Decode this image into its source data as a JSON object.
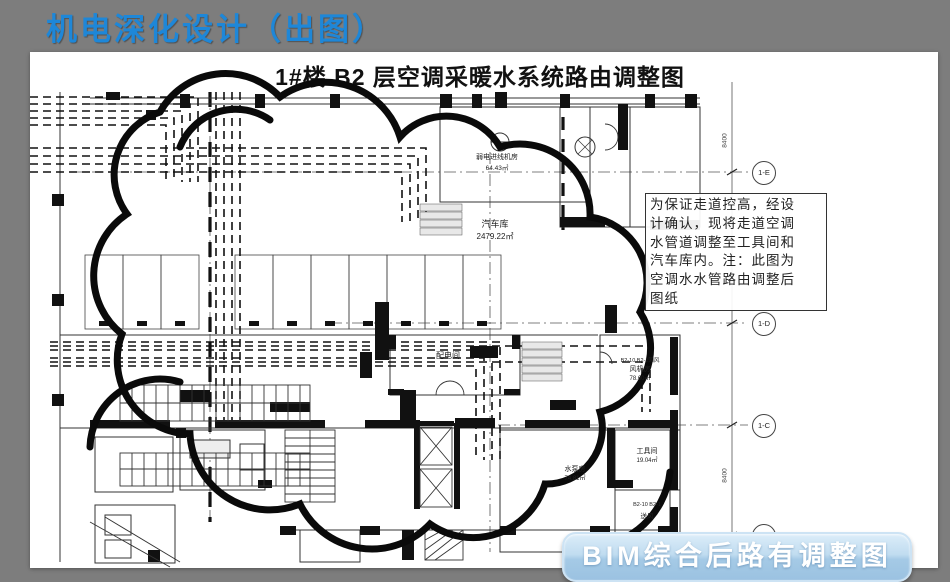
{
  "slide": {
    "title": "机电深化设计（出图）"
  },
  "drawing": {
    "title": "1#楼 B2 层空调采暖水系统路由调整图"
  },
  "annotation": {
    "text": "为保证走道控高，经设\n计确认，现将走道空调\n水管道调整至工具间和\n汽车库内。注：此图为\n空调水水管路由调整后\n图纸"
  },
  "caption_button": {
    "label": "BIM综合后路有调整图"
  },
  "plan": {
    "garage": {
      "name": "汽车库",
      "area": "2479.22㎡"
    },
    "rooms": [
      {
        "name": "弱电进线机房",
        "area": "64.43㎡"
      },
      {
        "name": "配电间"
      },
      {
        "note": "B2-10 B2-1回风",
        "name": "风机房",
        "area": "78.60㎡"
      },
      {
        "name": "工具间",
        "area": "19.04㎡"
      },
      {
        "name": "水泵房",
        "area": "74.81㎡"
      },
      {
        "note": "B2-10 B2-1",
        "name": "送风"
      }
    ],
    "grid_bubbles": [
      "1-E",
      "1-D",
      "1-C",
      "1-B"
    ],
    "dimension_label": "8400"
  },
  "colors": {
    "slide_background": "#7d7d7d",
    "title_blue": "#1e87d8",
    "button_blue_light": "#dcedf9",
    "button_blue_dark": "#9bc2e1",
    "ink": "#111111"
  }
}
